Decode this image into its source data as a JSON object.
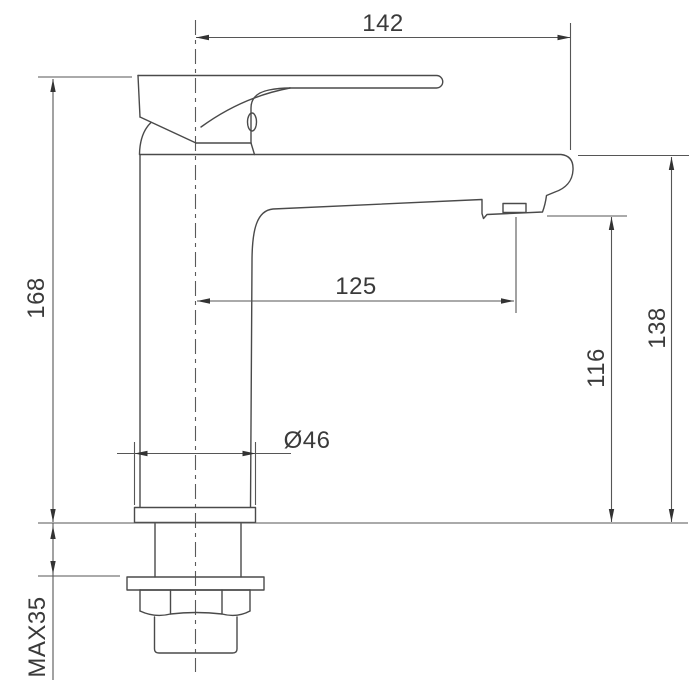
{
  "drawing": {
    "line_color": "#4a4a4a",
    "text_color": "#3a3a3a",
    "background_color": "#ffffff",
    "labels": {
      "top_width": "142",
      "total_height": "168",
      "spout_reach": "125",
      "spout_outlet_height": "116",
      "deck_to_spout_height": "138",
      "base_diameter": "Ø46",
      "max_counter_thickness": "MAX35"
    }
  }
}
